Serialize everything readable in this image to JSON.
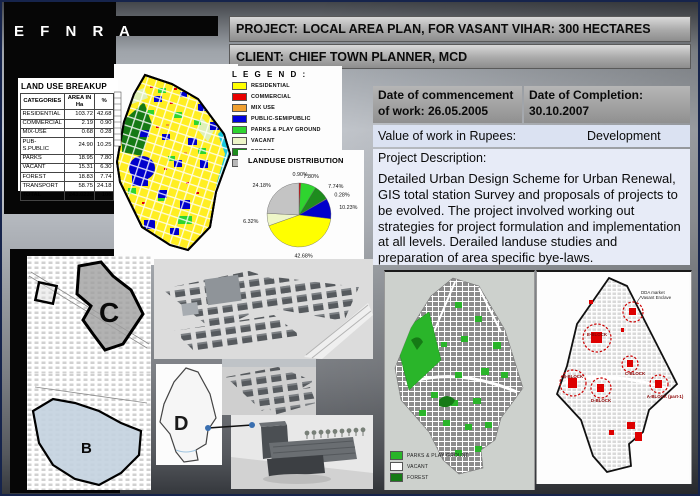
{
  "logo": {
    "text": "E F N R A"
  },
  "header": {
    "project_label": "PROJECT:",
    "project_title": "LOCAL AREA PLAN, FOR VASANT VIHAR: 300 HECTARES",
    "client_label": "CLIENT:",
    "client_name": "CHIEF TOWN  PLANNER, MCD"
  },
  "landuse_table": {
    "title": "LAND USE BREAKUP",
    "columns": [
      "CATEGORIES",
      "AREA IN Ha",
      "%"
    ],
    "rows": [
      [
        "RESIDENTIAL",
        "103.72",
        "42.68"
      ],
      [
        "COMMERCIAL",
        "2.19",
        "0.90"
      ],
      [
        "MIX-USE",
        "0.68",
        "0.28"
      ],
      [
        "PUB-S.PUBLIC",
        "24.90",
        "10.25"
      ],
      [
        "PARKS",
        "18.95",
        "7.80"
      ],
      [
        "VACANT",
        "15.31",
        "6.30"
      ],
      [
        "FOREST",
        "18.83",
        "7.74"
      ],
      [
        "TRANSPORT",
        "58.75",
        "24.18"
      ]
    ],
    "total_row": [
      "TOTAL",
      "243.0235",
      "100"
    ]
  },
  "legend": {
    "title": "L E G E N D :",
    "items": [
      {
        "label": "RESIDENTIAL",
        "color": "#ffff00"
      },
      {
        "label": "COMMERCIAL",
        "color": "#e80000"
      },
      {
        "label": "MIX USE",
        "color": "#f0a030"
      },
      {
        "label": "PUBLIC-SEMIPUBLIC",
        "color": "#0000dd"
      },
      {
        "label": "PARKS & PLAY GROUND",
        "color": "#2fd42f"
      },
      {
        "label": "VACANT",
        "color": "#eef6c8"
      },
      {
        "label": "FOREST",
        "color": "#1e8c1e"
      },
      {
        "label": "TRANSPORTATION",
        "color": "#b8b8b8"
      }
    ]
  },
  "chart_data": {
    "type": "pie",
    "title": "LANDUSE DISTRIBUTION",
    "labels": [
      "COMMERCIAL",
      "PARKS & PLAY GROUND",
      "FOREST",
      "MIX USE",
      "PUBLIC-SEMIPUBLIC",
      "RESIDENTIAL",
      "VACANT",
      "TRANSPORTATION"
    ],
    "values": [
      0.9,
      7.8,
      7.74,
      0.28,
      10.23,
      42.68,
      6.32,
      24.18
    ],
    "labels_pct": [
      "0.90%",
      "7.80%",
      "7.74%",
      "0.28%",
      "10.23%",
      "42.68%",
      "6.32%",
      "24.18%"
    ],
    "colors": [
      "#d40000",
      "#2fd42f",
      "#1e8c1e",
      "#f0a030",
      "#0000cc",
      "#ffff00",
      "#eef6c8",
      "#c4c4c4"
    ],
    "start": "top",
    "direction": "clockwise",
    "legend_position": "none"
  },
  "info": {
    "commencement": "Date of  commencement of work: 26.05.2005",
    "completion": "Date of Completion: 30.10.2007",
    "value_label": "Value of work in Rupees:",
    "value_text": "Development",
    "description_label": "Project Description:",
    "description_body": "Detailed Urban Design Scheme for Urban Renewal, GIS total station Survey and proposals of projects to be evolved. The project involved working out strategies for project formulation and implementation at all levels. Derailed landuse studies and preparation of  area specific bye-laws."
  },
  "bottom": {
    "zone_c": "C",
    "zone_b": "B",
    "zone_d": "D",
    "green_map_legend": [
      {
        "label": "PARKS & PLAY GROUND",
        "color": "#2ab52a"
      },
      {
        "label": "VACANT",
        "color": "#ffffff"
      },
      {
        "label": "FOREST",
        "color": "#157a15"
      }
    ],
    "red_map": {
      "top_label_line1": "DDA market",
      "top_label_line2": "Vasant Enclave",
      "blocks": [
        "E-BLOCK",
        "C-BLOCK",
        "B-BLOCK",
        "D-BLOCK",
        "A-BLOCK (part-1)"
      ]
    }
  }
}
